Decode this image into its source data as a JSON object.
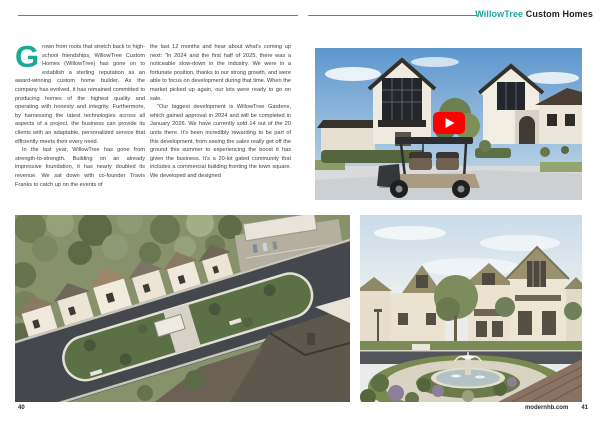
{
  "colors": {
    "accent": "#1ba99a",
    "text": "#3c3c3b",
    "rule": "#77787b",
    "play_red": "#ff0000"
  },
  "icons": {
    "play": "youtube-play-icon"
  },
  "header": {
    "brand_accent": "WillowTree",
    "brand_rest": "Custom Homes"
  },
  "article": {
    "drop_cap": "G",
    "col1": {
      "p1": "rown from roots that stretch back to high-school friendships, WillowTree Custom Homes (WillowTree) has gone on to establish a sterling reputation as an award-winning custom home builder. As the company has evolved, it has remained committed to producing homes of the highest quality and operating with honesty and integrity. Furthermore, by harnessing the latest technologies across all aspects of a project, the business can provide its clients with an adaptable, personalized service that efficiently meets their every need.",
      "p2": "In the last year, WillowTree has gone from strength-to-strength. Building on an already impressive foundation, it has nearly doubled its revenue. We sat down with co-founder Travis Franks to catch up on the events of"
    },
    "col2": {
      "p1": "the last 12 months and hear about what’s coming up next: “In 2024 and the first half of 2025, there was a noticeable slow-down in the industry. We were in a fortunate position, thanks to our strong growth, and were able to focus on development during that time. When the market picked up again, our lots were ready to go on sale.",
      "p2": "“Our biggest development is WillowTree Gardens, which gained approval in 2024 and will be completed in January 2026. We have currently sold 14 out of the 20 units there. It’s been incredibly rewarding to be part of this development, from seeing the sales really get off the ground this summer to experiencing the boost it has given the business. It’s a 20-lot gated community that includes a commercial building fronting the town square. We developed and designed"
    }
  },
  "footer": {
    "left_page_number": "40",
    "website": "modernhb.com",
    "right_page_number": "41"
  }
}
